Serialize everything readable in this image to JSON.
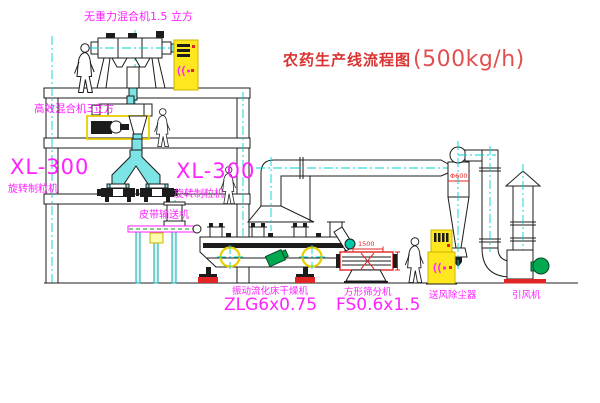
{
  "title": {
    "name": "农药生产线流程图",
    "capacity": "(500kg/h)"
  },
  "labels": {
    "gravity_mixer": "无重力混合机1.5 立方",
    "high_eff_mixer": "高效混合机3立方",
    "granulator_left_model": "XL-300",
    "granulator_left_name": "旋转制粒机",
    "granulator_mid_model": "XL-300",
    "granulator_mid_name": "旋转制粒机",
    "belt_conveyor": "皮带输送机",
    "dryer_name": "振动流化床干燥机",
    "dryer_model": "ZLG6x0.75",
    "sifter_name": "方形筛分机",
    "sifter_model": "FS0.6x1.5",
    "dust_collector": "送风除尘器",
    "induced_fan": "引风机"
  },
  "dimensions": {
    "cyclone_diameter": "Φ600",
    "sifter_length": "1500"
  },
  "colors": {
    "label_magenta": "#ff22ff",
    "annotation_red": "#e02525",
    "centerline_cyan": "#00d0d0",
    "cabinet_yellow": "#ffe71f",
    "motor_green": "#00a850"
  }
}
